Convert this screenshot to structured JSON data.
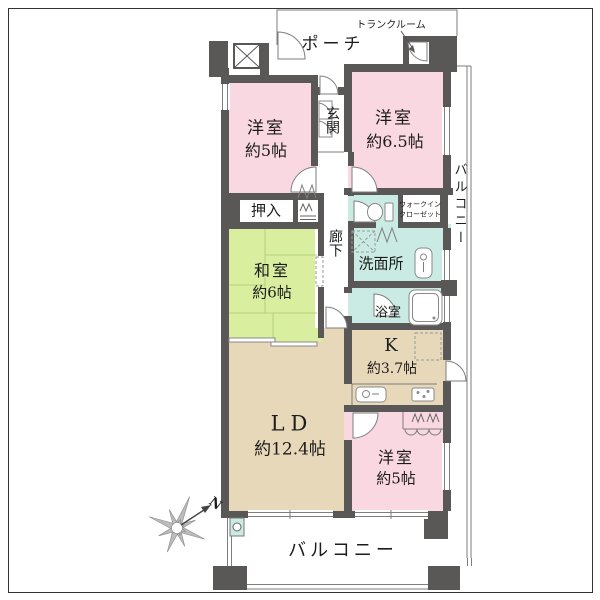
{
  "title": "マンション間取り図",
  "labels": {
    "porch": "ポーチ",
    "trunk_room": "トランクルーム",
    "western_tl_name": "洋室",
    "western_tl_size": "約5帖",
    "western_tr_name": "洋室",
    "western_tr_size": "約6.5帖",
    "entrance": "玄関",
    "corridor": "廊下",
    "oshiire": "押入",
    "japanese_name": "和室",
    "japanese_size": "約6帖",
    "walkin_line1": "ウォークイン",
    "walkin_line2": "クローゼット",
    "washroom": "洗面所",
    "bathroom": "浴室",
    "kitchen_name": "K",
    "kitchen_size": "約3.7帖",
    "living_name": "LD",
    "living_size": "約12.4帖",
    "western_br_name": "洋室",
    "western_br_size": "約5帖",
    "balcony_right": "バルコニー",
    "balcony_bottom": "バルコニー",
    "compass_n": "N"
  },
  "colors": {
    "wall": "#5a5757",
    "pink": "#f9d8e2",
    "green": "#d9ee9f",
    "teal": "#c9ebe3",
    "beige": "#e7d8ba",
    "line": "#7e7e7e",
    "tatami_line": "#b5d37e",
    "text": "#1c1c1c"
  }
}
